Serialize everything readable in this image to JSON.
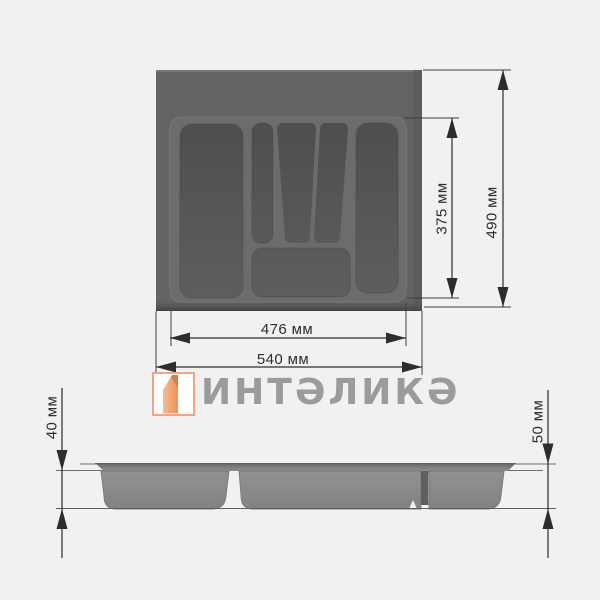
{
  "drawing": {
    "type": "technical-dimension-drawing",
    "views": {
      "top_view": "cutlery-tray-top",
      "side_view": "cutlery-tray-front-profile"
    }
  },
  "dimensions": {
    "inner_depth": "375 мм",
    "outer_depth": "490 мм",
    "inner_width": "476 мм",
    "outer_width": "540 мм",
    "tub_height": "40 мм",
    "total_height": "50 мм"
  },
  "logo": {
    "brand": "ИНТАЛИКА",
    "display_text": "ИНТƏЛИКƏ"
  },
  "colors": {
    "background": "#f1f1f1",
    "tray_blank": "#646464",
    "tray_surface": "#6c6c6c",
    "compartment": "#525252",
    "side_tray": "#8d8d8d",
    "dimension_lines": "#2d2d2d",
    "reference_lines": "#6e6e6e",
    "logo_text": "#9b9b9b",
    "logo_accent": "#f09a63"
  }
}
